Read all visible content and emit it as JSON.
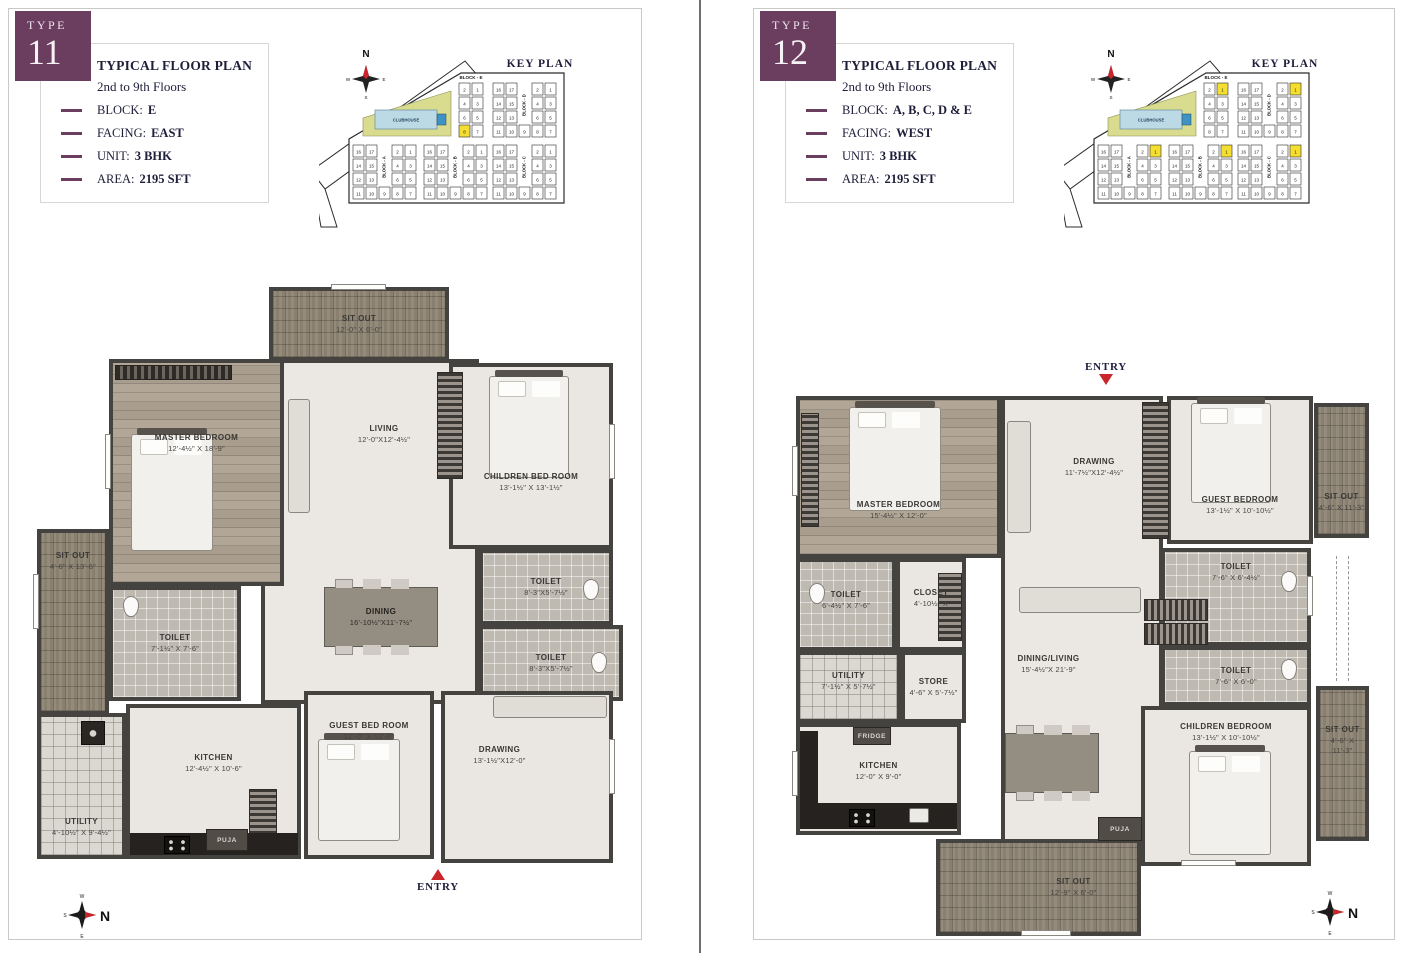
{
  "colors": {
    "accent_purple": "#6b3d5f",
    "highlight_yellow": "#f4df30",
    "entry_red": "#c9252b",
    "clubhouse_green": "#d9dc8f",
    "clubhouse_blue": "#bcd9e6",
    "title_navy": "#1e1e3a"
  },
  "shared": {
    "compass": {
      "n": "N",
      "e": "E",
      "s": "S",
      "w": "W"
    }
  },
  "keyplan_units": {
    "small_rows": [
      [
        2,
        1
      ],
      [
        4,
        3
      ],
      [
        6,
        5
      ],
      [
        8,
        7
      ]
    ],
    "full_left_rows": [
      [
        16,
        17
      ],
      [
        14,
        15
      ],
      [
        12,
        13
      ]
    ],
    "full_right_rows": [
      [
        2,
        1
      ],
      [
        4,
        3
      ],
      [
        6,
        5
      ]
    ],
    "full_bottom_row": [
      11,
      10,
      9,
      8,
      7
    ]
  },
  "p1": {
    "type_label": "TYPE",
    "type_number": "11",
    "info": {
      "title": "TYPICAL FLOOR PLAN",
      "subtitle": "2nd to 9th Floors",
      "rows": [
        {
          "label": "BLOCK:",
          "value": "E"
        },
        {
          "label": "FACING:",
          "value": "EAST"
        },
        {
          "label": "UNIT:",
          "value": "3 BHK"
        },
        {
          "label": "AREA:",
          "value": "2195 SFT"
        }
      ]
    },
    "keyplan": {
      "title": "KEY PLAN",
      "clubhouse": "CLUBHOUSE",
      "blocks": {
        "E": {
          "label": "BLOCK - E",
          "highlight": [
            8
          ]
        },
        "D": {
          "label": "BLOCK - D",
          "highlight": []
        },
        "A": {
          "label": "BLOCK - A",
          "highlight": []
        },
        "B": {
          "label": "BLOCK - B",
          "highlight": []
        },
        "C": {
          "label": "BLOCK - C",
          "highlight": []
        }
      }
    },
    "rooms": {
      "sitout_top": {
        "name": "SIT OUT",
        "dims": "12'-0\" X 6'-0\""
      },
      "master": {
        "name": "MASTER BEDROOM",
        "dims": "12'-4½\" X 18'-9\""
      },
      "living": {
        "name": "LIVING",
        "dims": "12'-0\"X12'-4½\""
      },
      "children": {
        "name": "CHILDREN BED ROOM",
        "dims": "13'-1½\" X 13'-1½\""
      },
      "toilet1": {
        "name": "TOILET",
        "dims": "8'-3\"X5'-7½\""
      },
      "toilet2": {
        "name": "TOILET",
        "dims": "8'-3\"X5'-7½\""
      },
      "dining": {
        "name": "DINING",
        "dims": "16'-10½\"X11'-7½\""
      },
      "sitout_left": {
        "name": "SIT OUT",
        "dims": "4'-6\" X 13'-6\""
      },
      "toilet3": {
        "name": "TOILET",
        "dims": "7'-1½\" X 7'-6\""
      },
      "utility": {
        "name": "UTILITY",
        "dims": "4'-10½\" X 9'-4½\""
      },
      "kitchen": {
        "name": "KITCHEN",
        "dims": "12'-4½\" X 10'-6\""
      },
      "guest": {
        "name": "GUEST BED ROOM",
        "dims": "12'-0\" X 12'-0\""
      },
      "drawing": {
        "name": "DRAWING",
        "dims": "13'-1½\"X12'-0\""
      },
      "puja": {
        "name": "PUJA"
      }
    },
    "entry": "ENTRY"
  },
  "p2": {
    "type_label": "TYPE",
    "type_number": "12",
    "info": {
      "title": "TYPICAL FLOOR PLAN",
      "subtitle": "2nd to 9th Floors",
      "rows": [
        {
          "label": "BLOCK:",
          "value": "A, B, C, D & E"
        },
        {
          "label": "FACING:",
          "value": "WEST"
        },
        {
          "label": "UNIT:",
          "value": "3 BHK"
        },
        {
          "label": "AREA:",
          "value": "2195 SFT"
        }
      ]
    },
    "keyplan": {
      "title": "KEY PLAN",
      "clubhouse": "CLUBHOUSE",
      "blocks": {
        "E": {
          "label": "BLOCK - E",
          "highlight": [
            1
          ]
        },
        "D": {
          "label": "BLOCK - D",
          "highlight": [
            1
          ]
        },
        "A": {
          "label": "BLOCK - A",
          "highlight": [
            1
          ]
        },
        "B": {
          "label": "BLOCK - B",
          "highlight": [
            1
          ]
        },
        "C": {
          "label": "BLOCK - C",
          "highlight": [
            1
          ]
        }
      }
    },
    "rooms": {
      "master": {
        "name": "MASTER BEDROOM",
        "dims": "15'-4½\" X 12'-0\""
      },
      "drawing": {
        "name": "DRAWING",
        "dims": "11'-7½\"X12'-4½\""
      },
      "guest": {
        "name": "GUEST BEDROOM",
        "dims": "13'-1½\" X 10'-10½\""
      },
      "sitout_tr": {
        "name": "SIT OUT",
        "dims": "4'-6\" X 11'-3\""
      },
      "toilet_left": {
        "name": "TOILET",
        "dims": "6'-4½\" X 7'-6\""
      },
      "closet": {
        "name": "CLOSET",
        "dims": "4'-10½\" X"
      },
      "utility": {
        "name": "UTILITY",
        "dims": "7'-1½\" X 5'-7½\""
      },
      "store": {
        "name": "STORE",
        "dims": "4'-6\" X 5'-7½\""
      },
      "kitchen": {
        "name": "KITCHEN",
        "dims": "12'-0\" X 9'-0\""
      },
      "fridge": {
        "name": "FRIDGE"
      },
      "dining_living": {
        "name": "DINING/LIVING",
        "dims": "15'-4½\"X 21'-9\""
      },
      "toilet_r1": {
        "name": "TOILET",
        "dims": "7'-6\" X 6'-4½\""
      },
      "toilet_r2": {
        "name": "TOILET",
        "dims": "7'-6\" X 6'-0\""
      },
      "children": {
        "name": "CHILDREN BEDROOM",
        "dims": "13'-1½\" X 10'-10½\""
      },
      "sitout_r2": {
        "name": "SIT OUT",
        "dims": "4'-6\" X 11'-3\""
      },
      "puja": {
        "name": "PUJA"
      },
      "sitout_bottom": {
        "name": "SIT OUT",
        "dims": "12'-9\" X 6'-0\""
      }
    },
    "entry": "ENTRY"
  }
}
